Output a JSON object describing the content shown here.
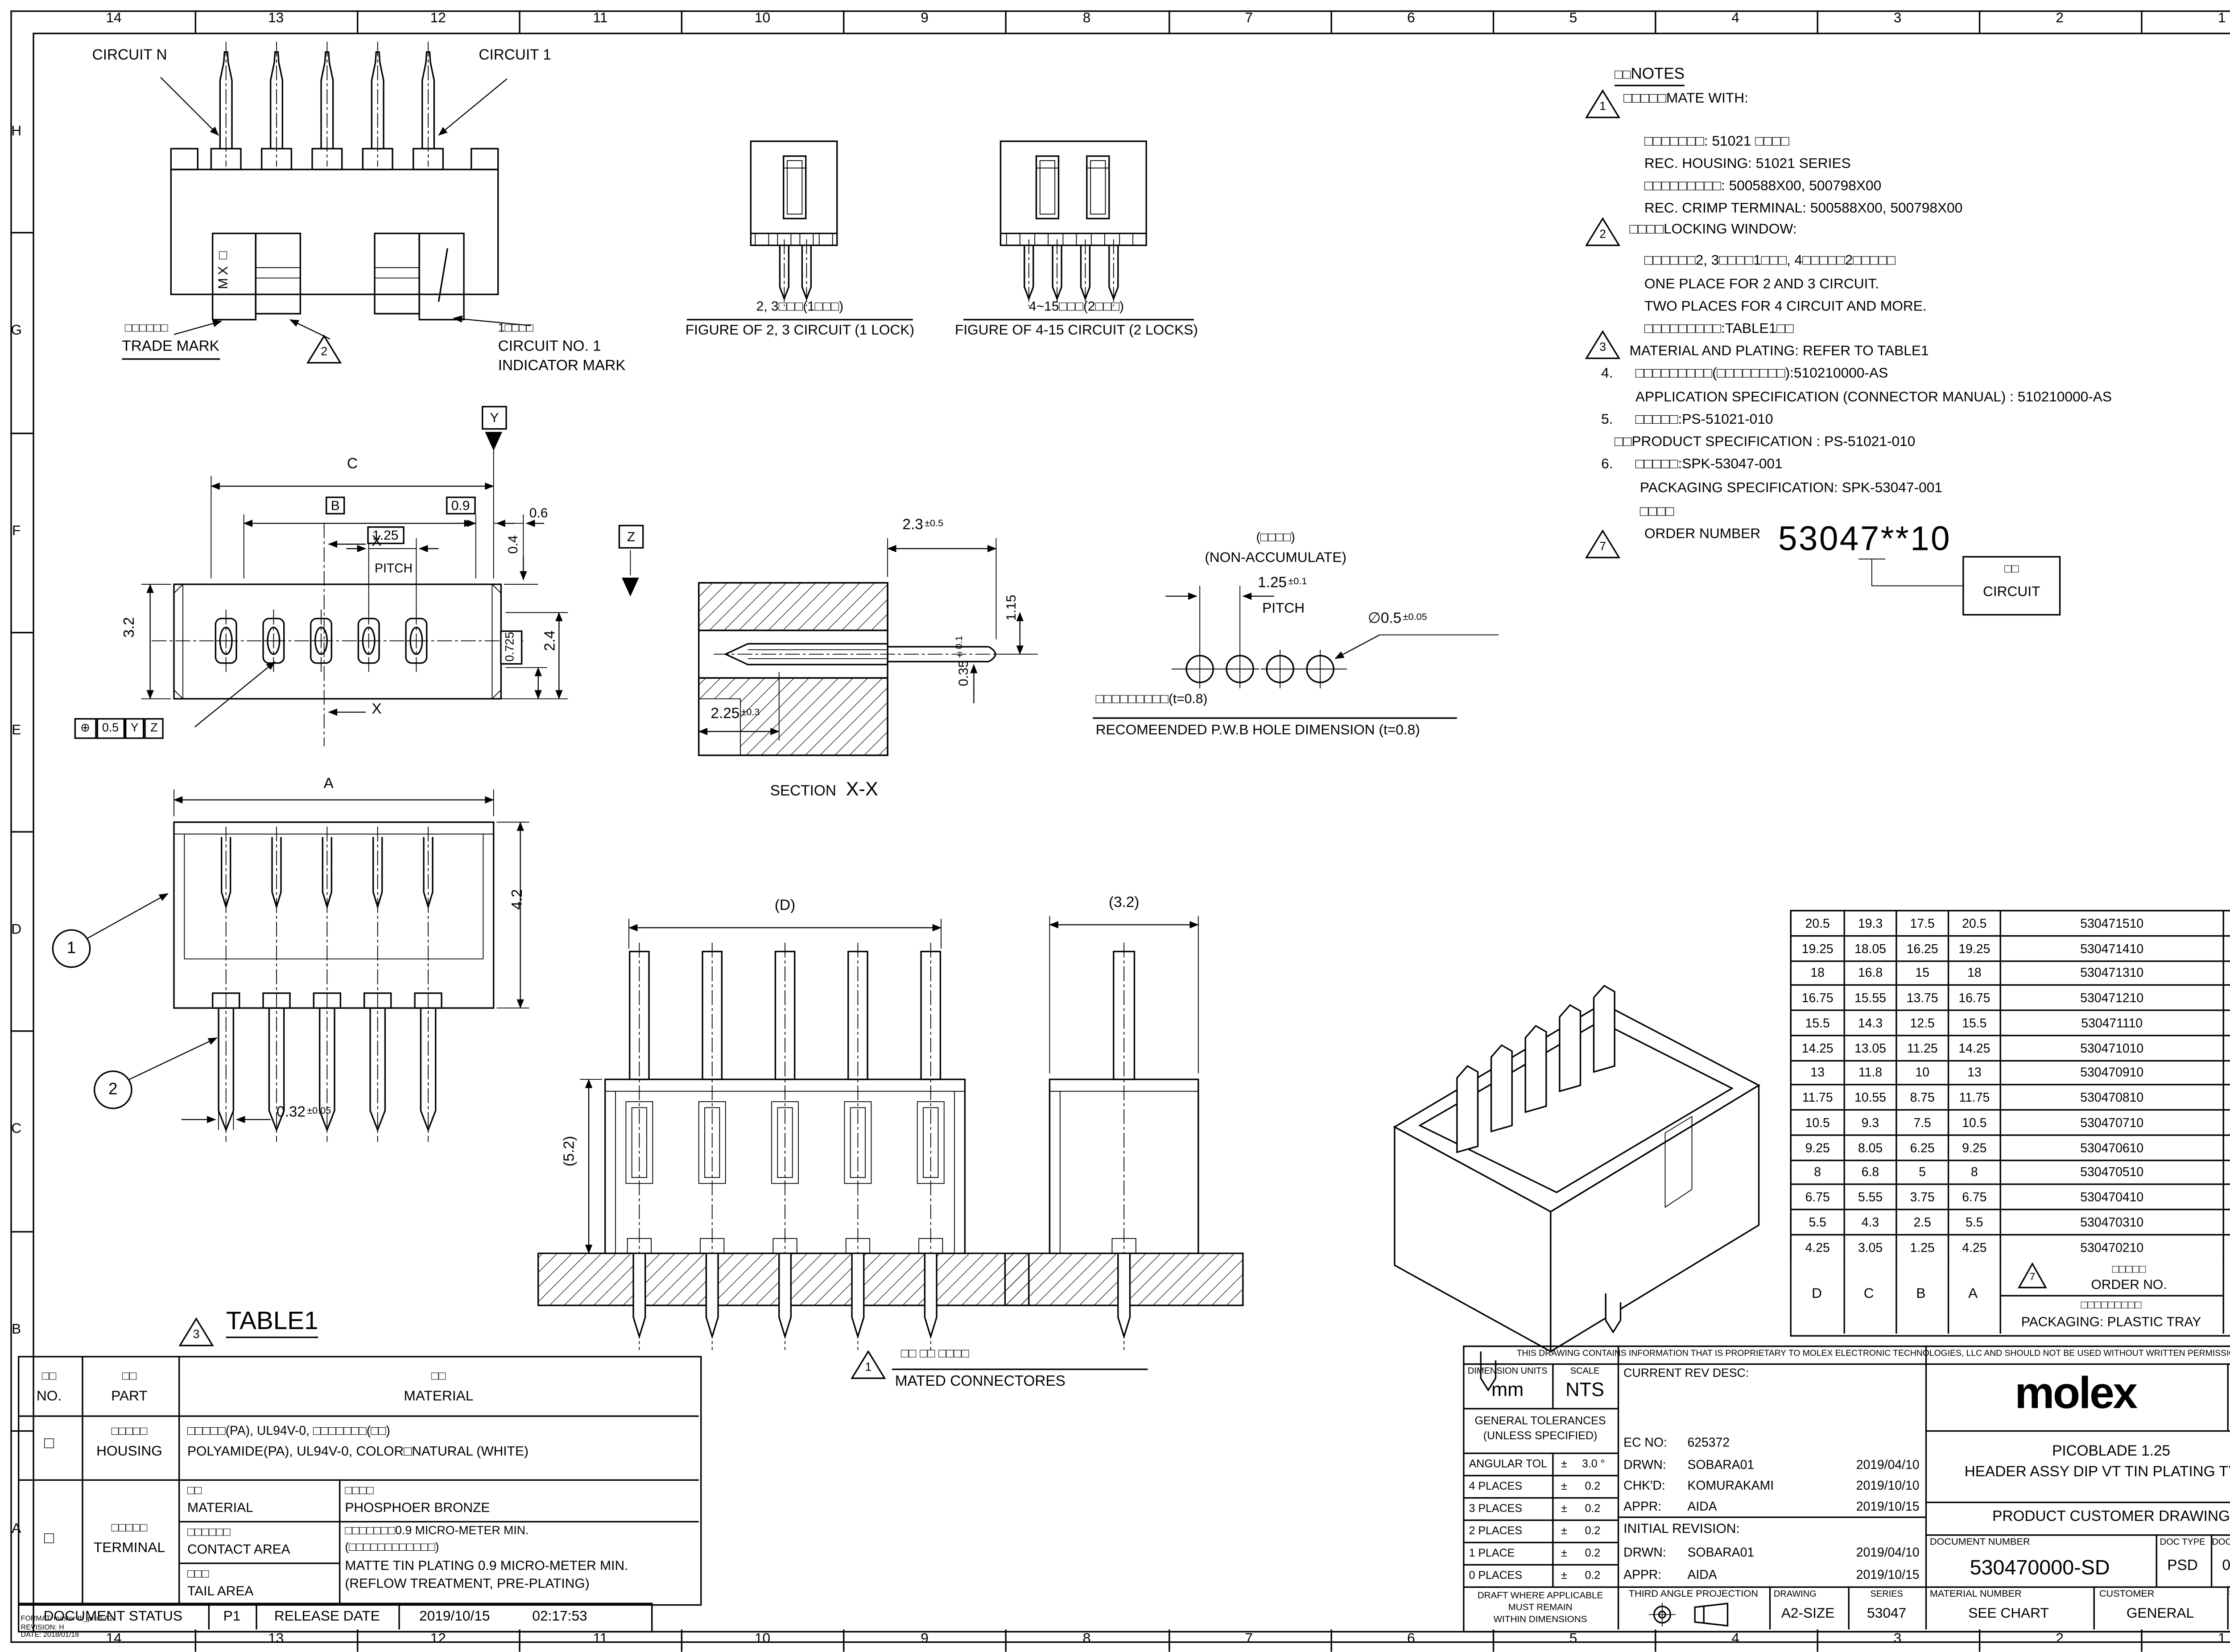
{
  "frame": {
    "columns": [
      "14",
      "13",
      "12",
      "11",
      "10",
      "9",
      "8",
      "7",
      "6",
      "5",
      "4",
      "3",
      "2",
      "1"
    ],
    "rows": [
      "H",
      "G",
      "F",
      "E",
      "D",
      "C",
      "B",
      "A"
    ]
  },
  "views": {
    "front": {
      "circuit_n": "CIRCUIT N",
      "circuit_1": "CIRCUIT 1",
      "trade_mark_jp": "□□□□□□",
      "trade_mark_en": "TRADE MARK",
      "tri2": "2",
      "logo": "MX□",
      "indicator_jp": "1□□□□",
      "indicator_l1": "CIRCUIT NO. 1",
      "indicator_l2": "INDICATOR MARK"
    },
    "fig23": {
      "jp": "2, 3□□□(1□□□)",
      "en": "FIGURE OF 2, 3 CIRCUIT (1 LOCK)"
    },
    "fig415": {
      "jp": "4~15□□□(2□□□)",
      "en": "FIGURE OF 4-15 CIRCUIT (2 LOCKS)"
    },
    "top": {
      "c": "C",
      "b": "B",
      "d09": "0.9",
      "d06": "0.6",
      "pitch_val": "1.25",
      "pitch": "PITCH",
      "d04": "0.4",
      "d32": "3.2",
      "d24": "2.4",
      "d0725": "0.725",
      "x": "X",
      "y": "Y",
      "z": "Z",
      "fcf_sym": "⊕",
      "fcf_val": "0.5",
      "fcf_d1": "Y",
      "fcf_d2": "Z"
    },
    "section": {
      "d23": "2.3",
      "d23_tol": "±0.5",
      "d115": "1.15",
      "d035": "0.35",
      "d035_tol": "±0.1",
      "d225": "2.25",
      "d225_tol": "±0.3",
      "label": "SECTION",
      "xx": "X-X"
    },
    "pwb": {
      "jp": "(□□□□)",
      "en": "(NON-ACCUMULATE)",
      "pitch_val": "1.25",
      "pitch_tol": "±0.1",
      "pitch": "PITCH",
      "dia": "∅0.5",
      "dia_tol": "±0.05",
      "cap_jp": "□□□□□□□□□(t=0.8)",
      "cap_en": "RECOMEENDED P.W.B HOLE DIMENSION (t=0.8)"
    },
    "side": {
      "a": "A",
      "balloon1": "1",
      "balloon2": "2",
      "d42": "4.2",
      "d032": "0.32",
      "d032_tol": "±0.05"
    },
    "pcb_front": {
      "dd": "(D)",
      "d52": "(5.2)"
    },
    "pcb_side": {
      "d32": "(3.2)"
    },
    "mated": {
      "tri": "1",
      "jp": "□□ □□ □□□□",
      "en": "MATED CONNECTORES"
    }
  },
  "notes": {
    "title_jp": "□□",
    "title_en": "NOTES",
    "tri1": "1",
    "n1_head": "□□□□□MATE WITH:",
    "n1_l1": "□□□□□□□: 51021 □□□□",
    "n1_l2": "REC. HOUSING: 51021 SERIES",
    "n1_l3": "□□□□□□□□□: 500588X00, 500798X00",
    "n1_l4": "REC. CRIMP TERMINAL: 500588X00, 500798X00",
    "tri2": "2",
    "n2_head": "□□□□LOCKING WINDOW:",
    "n2_l1": "□□□□□□2, 3□□□□1□□□, 4□□□□□2□□□□□",
    "n2_l2": "ONE PLACE FOR 2 AND 3 CIRCUIT.",
    "n2_l3": "TWO PLACES FOR 4 CIRCUIT AND MORE.",
    "n3_jp": "□□□□□□□□□:TABLE1□□",
    "tri3": "3",
    "n3_en": "MATERIAL AND PLATING: REFER TO TABLE1",
    "n4_no": "4.",
    "n4_jp": "□□□□□□□□□(□□□□□□□□):510210000-AS",
    "n4_en": "APPLICATION SPECIFICATION (CONNECTOR MANUAL) : 510210000-AS",
    "n5_no": "5.",
    "n5_jp": "□□□□□:PS-51021-010",
    "n5_en": "□□PRODUCT SPECIFICATION : PS-51021-010",
    "n6_no": "6.",
    "n6_jp": "□□□□□:SPK-53047-001",
    "n6_en": "PACKAGING SPECIFICATION: SPK-53047-001"
  },
  "order": {
    "jp": "□□□□",
    "en": "ORDER NUMBER",
    "tri": "7",
    "number": "53047**10",
    "box_jp": "□□",
    "box_en": "CIRCUIT"
  },
  "part_table": {
    "rows": [
      [
        "20.5",
        "19.3",
        "17.5",
        "20.5",
        "530471510",
        "15"
      ],
      [
        "19.25",
        "18.05",
        "16.25",
        "19.25",
        "530471410",
        "14"
      ],
      [
        "18",
        "16.8",
        "15",
        "18",
        "530471310",
        "13"
      ],
      [
        "16.75",
        "15.55",
        "13.75",
        "16.75",
        "530471210",
        "12"
      ],
      [
        "15.5",
        "14.3",
        "12.5",
        "15.5",
        "530471110",
        "11"
      ],
      [
        "14.25",
        "13.05",
        "11.25",
        "14.25",
        "530471010",
        "10"
      ],
      [
        "13",
        "11.8",
        "10",
        "13",
        "530470910",
        "9"
      ],
      [
        "11.75",
        "10.55",
        "8.75",
        "11.75",
        "530470810",
        "8"
      ],
      [
        "10.5",
        "9.3",
        "7.5",
        "10.5",
        "530470710",
        "7"
      ],
      [
        "9.25",
        "8.05",
        "6.25",
        "9.25",
        "530470610",
        "6"
      ],
      [
        "8",
        "6.8",
        "5",
        "8",
        "530470510",
        "5"
      ],
      [
        "6.75",
        "5.55",
        "3.75",
        "6.75",
        "530470410",
        "4"
      ],
      [
        "5.5",
        "4.3",
        "2.5",
        "5.5",
        "530470310",
        "3"
      ],
      [
        "4.25",
        "3.05",
        "1.25",
        "4.25",
        "530470210",
        "2"
      ]
    ],
    "footer": [
      "D",
      "C",
      "B",
      "A"
    ],
    "order_tri": "7",
    "order_jp": "□□□□□",
    "order_en": "ORDER NO.",
    "pack_jp": "□□□□□□□□□",
    "pack_en": "PACKAGING: PLASTIC TRAY",
    "circuit_jp": "□□",
    "circuit_en": "CIRCUIT"
  },
  "table1": {
    "tri": "3",
    "title": "TABLE1",
    "no_jp": "□□",
    "no_en": "NO.",
    "part_jp": "□□",
    "part_en": "PART",
    "mat_jp": "□□",
    "mat_en": "MATERIAL",
    "housing_no": "□",
    "housing_jp": "□□□□□",
    "housing_en": "HOUSING",
    "housing_val_jp": "□□□□□(PA), UL94V-0, □□□□□□□(□□)",
    "housing_val_en": "POLYAMIDE(PA), UL94V-0, COLOR□NATURAL (WHITE)",
    "terminal_no": "□",
    "terminal_jp": "□□□□□",
    "terminal_en": "TERMINAL",
    "tmat_jp": "□□",
    "tmat_en": "MATERIAL",
    "tmat_val_jp": "□□□□",
    "tmat_val_en": "PHOSPHOER BRONZE",
    "contact_jp": "□□□□□□",
    "contact_en": "CONTACT AREA",
    "tail_jp": "□□□",
    "tail_en": "TAIL AREA",
    "plate_l1": "□□□□□□□0.9 MICRO-METER MIN.",
    "plate_l2": "(□□□□□□□□□□□□)",
    "plate_l3": "MATTE TIN PLATING 0.9 MICRO-METER MIN.",
    "plate_l4": "(REFLOW TREATMENT, PRE-PLATING)"
  },
  "doc_status": {
    "label": "DOCUMENT STATUS",
    "value": "P1",
    "release": "RELEASE DATE",
    "date": "2019/10/15",
    "time": "02:17:53"
  },
  "footer_small": {
    "l1": "FORMAT: master-tb_prod-A2",
    "l2": "REVISION: H",
    "l3": "DATE: 2018/01/18"
  },
  "title_block": {
    "proprietary": "THIS DRAWING CONTAINS INFORMATION THAT IS PROPRIETARY TO MOLEX ELECTRONIC TECHNOLOGIES, LLC AND SHOULD NOT BE USED WITHOUT WRITTEN PERMISSION",
    "dim_units_label": "DIMENSION UNITS",
    "dim_units": "mm",
    "scale_label": "SCALE",
    "scale": "NTS",
    "gen_tol1": "GENERAL TOLERANCES",
    "gen_tol2": "(UNLESS SPECIFIED)",
    "angular_label": "ANGULAR TOL",
    "angular_pm": "±",
    "angular_val": "3.0 °",
    "tol_rows": [
      [
        "4 PLACES",
        "±",
        "0.2"
      ],
      [
        "3 PLACES",
        "±",
        "0.2"
      ],
      [
        "2 PLACES",
        "±",
        "0.2"
      ],
      [
        "1 PLACE",
        "±",
        "0.2"
      ],
      [
        "0 PLACES",
        "±",
        "0.2"
      ]
    ],
    "draft_l1": "DRAFT WHERE APPLICABLE",
    "draft_l2": "MUST REMAIN",
    "draft_l3": "WITHIN DIMENSIONS",
    "projection": "THIRD ANGLE PROJECTION",
    "current_rev": "CURRENT REV DESC:",
    "ec_label": "EC NO:",
    "ec": "625372",
    "drwn_label": "DRWN:",
    "drwn": "SOBARA01",
    "drwn_date": "2019/04/10",
    "chkd_label": "CHK'D:",
    "chkd": "KOMURAKAMI",
    "chkd_date": "2019/10/10",
    "appr_label": "APPR:",
    "appr": "AIDA",
    "appr_date": "2019/10/15",
    "initial_rev": "INITIAL REVISION:",
    "drwn2_label": "DRWN:",
    "drwn2": "SOBARA01",
    "drwn2_date": "2019/04/10",
    "appr2_label": "APPR:",
    "appr2": "AIDA",
    "appr2_date": "2019/10/15",
    "brand": "molex",
    "desc1": "PICOBLADE 1.25",
    "desc2": "HEADER ASSY DIP VT TIN PLATING TYPE",
    "doc_title": "PRODUCT CUSTOMER DRAWING",
    "doc_num_label": "DOCUMENT NUMBER",
    "doc_num": "530470000-SD",
    "doc_type_label": "DOC TYPE",
    "doc_type": "PSD",
    "doc_part_label": "DOC PART",
    "doc_part": "000",
    "rev_label": "REVISION",
    "rev": "A",
    "drawing_label": "DRAWING",
    "drawing": "A2-SIZE",
    "series_label": "SERIES",
    "series": "53047",
    "mat_label": "MATERIAL NUMBER",
    "mat": "SEE CHART",
    "cust_label": "CUSTOMER",
    "cust": "GENERAL",
    "sheet_label": "SHEET NUMBER",
    "sheet": "1 OF 1"
  }
}
